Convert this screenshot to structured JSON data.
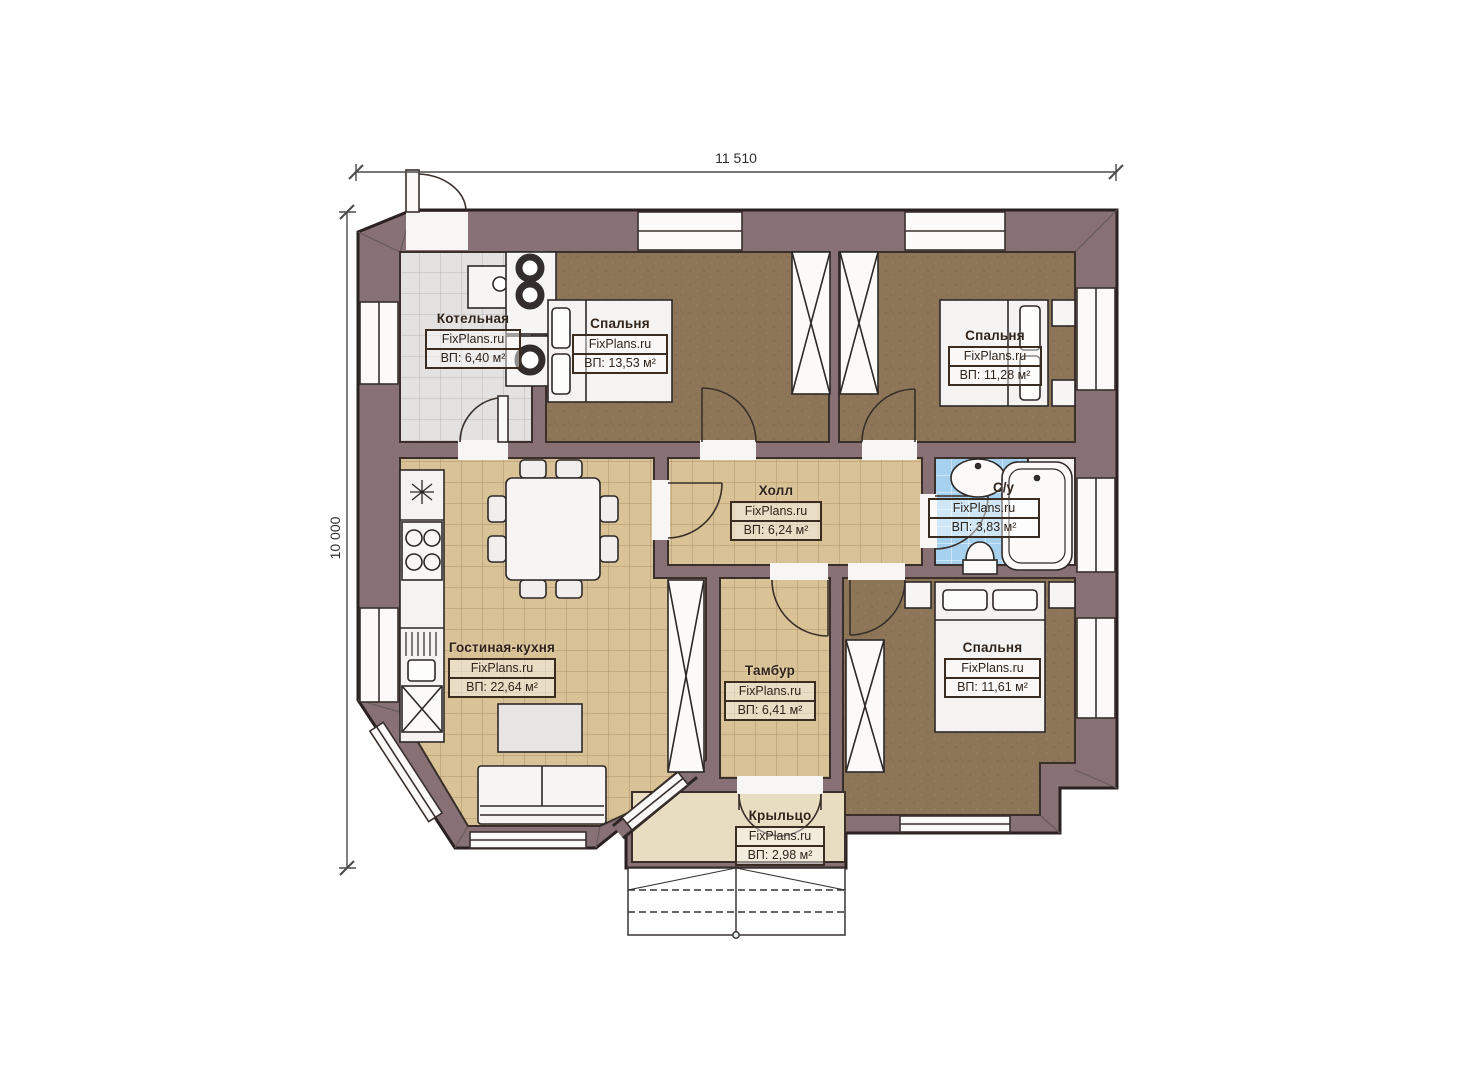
{
  "dimensions": {
    "width_label": "11 510",
    "height_label": "10 000"
  },
  "rooms": [
    {
      "id": "kotelnaya",
      "name": "Котельная",
      "brand": "FixPlans.ru",
      "area": "ВП: 6,40 м²"
    },
    {
      "id": "spalnya-1",
      "name": "Спальня",
      "brand": "FixPlans.ru",
      "area": "ВП: 13,53 м²"
    },
    {
      "id": "spalnya-2",
      "name": "Спальня",
      "brand": "FixPlans.ru",
      "area": "ВП: 11,28 м²"
    },
    {
      "id": "holl",
      "name": "Холл",
      "brand": "FixPlans.ru",
      "area": "ВП: 6,24 м²"
    },
    {
      "id": "sanuzel",
      "name": "С/у",
      "brand": "FixPlans.ru",
      "area": "ВП: 3,83 м²"
    },
    {
      "id": "gostinaya-kuhnya",
      "name": "Гостиная-кухня",
      "brand": "FixPlans.ru",
      "area": "ВП: 22,64 м²"
    },
    {
      "id": "tambur",
      "name": "Тамбур",
      "brand": "FixPlans.ru",
      "area": "ВП: 6,41 м²"
    },
    {
      "id": "spalnya-3",
      "name": "Спальня",
      "brand": "FixPlans.ru",
      "area": "ВП: 11,61 м²"
    },
    {
      "id": "krylco",
      "name": "Крыльцо",
      "brand": "FixPlans.ru",
      "area": "ВП: 2,98 м²"
    }
  ],
  "colors": {
    "wall": "#877174",
    "bedroom_floor": "#8d7658",
    "tile_beige": "#d9c295",
    "tile_gray": "#e4e2e1",
    "tile_blue": "#a6d2ef",
    "porch_floor": "#e9ddc1"
  }
}
